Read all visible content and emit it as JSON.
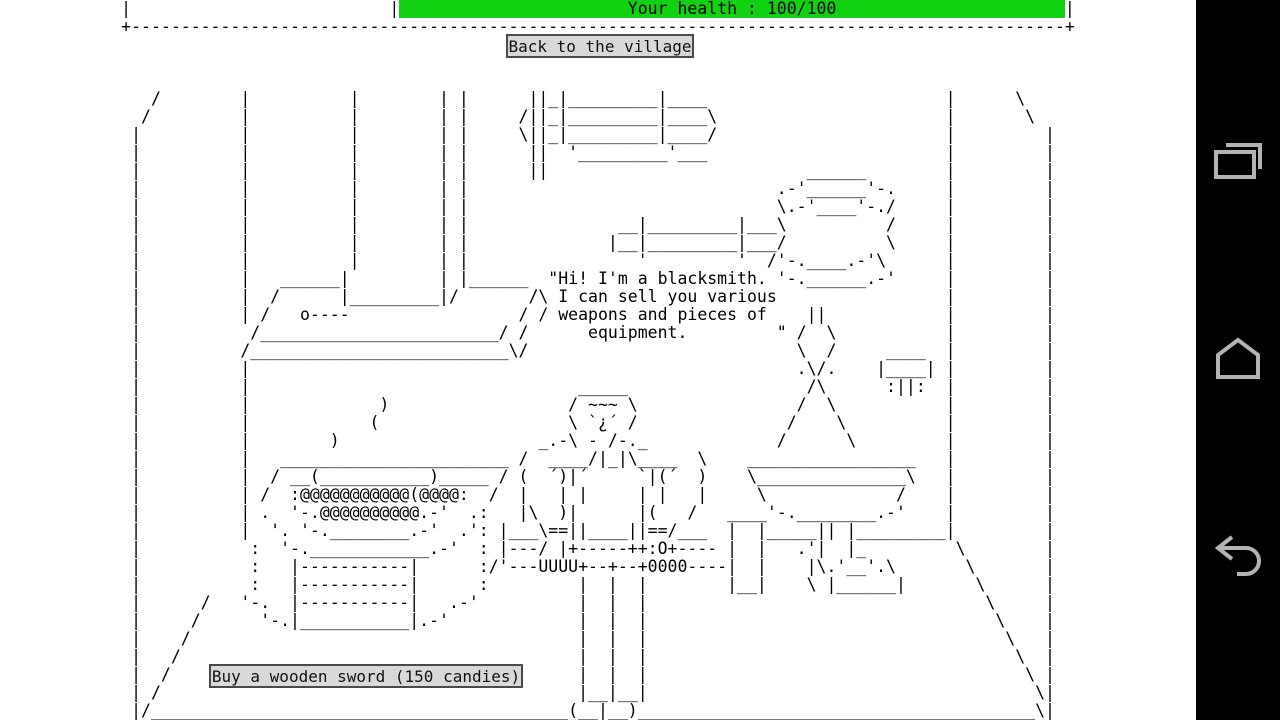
{
  "colors": {
    "health_green": "#12d112",
    "button_bg": "#d9d9d9",
    "button_border": "#4a4a4a",
    "nav_bg": "#000000",
    "nav_icon": "#b3b3b3"
  },
  "health": {
    "prefix": "|                          |",
    "bar_text": "                       Your health : 100/100                       ",
    "suffix": "|",
    "label": "Your health : 100/100",
    "value": "100/100"
  },
  "buttons": {
    "back_label": "Back to the village",
    "buy_label": "Buy a wooden sword (150 candies)"
  },
  "dialogue": "Hi! I'm a blacksmith. I can sell you various weapons and pieces of equipment.",
  "nav": {
    "icons": [
      "recent-apps-icon",
      "home-icon",
      "back-icon"
    ]
  },
  "scene": {
    "art_lines": [
      "",
      "+----------------------------------------------------------------------------------------------+",
      "",
      "",
      "",
      "   /        |          |        | |      ||_|_________|____                        |      \\",
      "  /         |          |        | |     /||_|_________|____\\                       |       \\",
      " |          |          |        | |     \\||_|_________|____/                       |         |",
      " |          |          |        | |      ||  '_________'___                        |         |",
      " |          |          |        | |      ||                          ______        |         |",
      " |          |          |        | |                               .-'______'-.     |         |",
      " |          |          |        | |                               \\.-'____'-./     |         |",
      " |          |          |        | |               __|_________|___\\          /     |         |",
      " |          |          |        | |              |__|_________|___/          \\     |         |",
      " |          |          |        | |                 '         '  /'-.____.-'\\      |         |",
      " |          |   ______|         | |______  \"Hi! I'm a blacksmith. '-.______.-'     |         |",
      " |          |  /      |_________|/       /\\ I can sell you various                 |         |",
      " |          | /   o----                 / / weapons and pieces of    ||            |         |",
      " |           /________________________/ /      equipment.         \" /  \\           |         |",
      " |          /__________________________\\/                           \\  /     ____  |         |",
      " |          |                                                       .\\/.    |____| |         |",
      " |          |                                 _____                  /\\      :||:  |         |",
      " |          |             )                  / ~~~ \\                /  \\           |         |",
      " |          |            (                   \\ `¿´ /               /    \\          |         |",
      " |          |        )                    _.-\\ - /-._             /      \\         |         |",
      " |          |   _______________________ /  ____/|_|\\____  \\    _________________   |         |",
      " |          |  / __(___________)_____ / (  ´)|´     `|(´  )    \\_______________\\   |         |",
      " |          | /  :@@@@@@@@@@@(@@@@:  /  |   | |     | |   |     \\             /    |         |",
      " |          | .  '-.@@@@@@@@@@.-'  .:   |\\  )|      |(   /   ____'-.________.-'    |         |",
      " |          |  '. '-.________.-'  .': |___\\==||____||==/___  |  |_____|| |_________|         |",
      " |           :  '-.____________.-'  : |---/ |+-----++:O+---- |  |   .'|  |_         \\        |",
      " |           :   |-----------|      :/'---UUUU+--+--+0000----|  |    |\\.'__'.\\       \\       |",
      " |           :   |-----------|      :         |  |  |        |__|    \\ |______|       \\      |",
      " |      /   '-.  |-----------|   .-'          |  |  |                                  \\     |",
      " |     /      '-.|___________|.-'             |  |  |                                   \\    |",
      " |    /                                       |  |  |                                    \\   |",
      " |   /                                        |  |  |                                     \\  |",
      " |  /                                         |  |  |                                      \\ |",
      " | /                                          |__|__|                                       \\|",
      " |/__________________________________________(__|__)________________________________________\\|"
    ]
  }
}
